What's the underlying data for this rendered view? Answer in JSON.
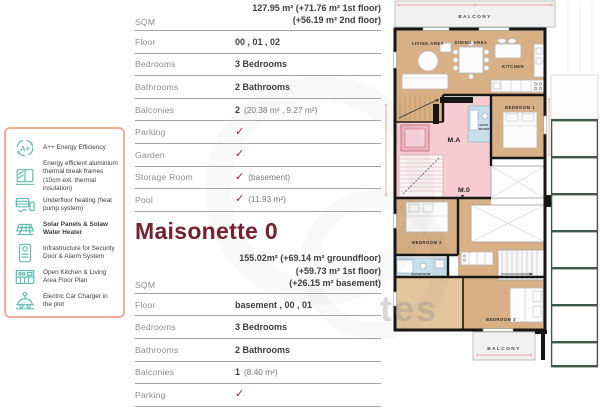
{
  "features": {
    "items": [
      {
        "icon": "energy-rating-icon",
        "label": "A++ Energy Efficiency"
      },
      {
        "icon": "window-frame-icon",
        "label": "Energy efficient aluminium thermal break frames (10cm ext. thermal insulation)"
      },
      {
        "icon": "underfloor-heating-icon",
        "label": "Underfloor heating (heat pump system)"
      },
      {
        "icon": "solar-panel-icon",
        "label": "Solar Panels & Solaw Water Heater"
      },
      {
        "icon": "security-icon",
        "label": "Infrastructure for Security Door & Alarm System"
      },
      {
        "icon": "kitchen-icon",
        "label": "Open Kitchen & Living Area Floor Plan"
      },
      {
        "icon": "car-charger-icon",
        "label": "Electric Car Charger in the plot"
      }
    ]
  },
  "unit_top": {
    "sqm_label": "SQM",
    "sqm_lines": [
      "127.95 m² (+71.76 m² 1st floor)",
      "(+56.19 m² 2nd floor)"
    ],
    "rows": [
      {
        "label": "Floor",
        "value": "00 , 01 , 02"
      },
      {
        "label": "Bedrooms",
        "value": "3 Bedrooms"
      },
      {
        "label": "Bathrooms",
        "value": "2 Bathrooms"
      },
      {
        "label": "Balconies",
        "value": "2",
        "muted": "(20.38 m² , 9.27 m²)"
      },
      {
        "label": "Parking",
        "check": "✓"
      },
      {
        "label": "Garden",
        "check": "✓"
      },
      {
        "label": "Storage Room",
        "check": "✓",
        "muted": "(basement)"
      },
      {
        "label": "Pool",
        "check": "✓",
        "muted": "(11.93 m²)"
      }
    ]
  },
  "maisonette": {
    "title": "Maisonette 0",
    "sqm_label": "SQM",
    "sqm_lines": [
      "155.02m²  (+69.14 m² groundfloor)",
      "(+59.73 m² 1st floor)",
      "(+26.15 m² basement)"
    ],
    "rows": [
      {
        "label": "Floor",
        "value": "basement , 00 , 01"
      },
      {
        "label": "Bedrooms",
        "value": "3 Bedrooms"
      },
      {
        "label": "Bathrooms",
        "value": "2 Bathrooms"
      },
      {
        "label": "Balconies",
        "value": "1",
        "muted": "(8.40 m²)"
      },
      {
        "label": "Parking",
        "check": "✓"
      }
    ]
  },
  "floorplan": {
    "balcony_top": "BALCONY",
    "living_area": "LIVING AREA",
    "dining_area": "DINING AREA",
    "kitchen": "KITCHEN",
    "bedroom_1": "BEDROOM 1",
    "bath_line1": "BATH",
    "bath_line2": "ROOM",
    "unit_a": "M.A",
    "unit_0": "M.0",
    "bedroom_2": "BEDROOM 2",
    "bathroom": "BATHROOM",
    "bedroom_3": "BEDROOM 3",
    "balcony_bottom": "BALCONY"
  },
  "watermark": "tes",
  "colors": {
    "maroon": "#74222F",
    "check": "#8E2438",
    "teal": "#5FBDB2",
    "panel-border": "#F5AC9E",
    "wood": "#D9B086",
    "pink": "#F6CBD1",
    "blue": "#C8E0EC",
    "wall": "#161616",
    "balc": "#F1F1F1",
    "pergola": "#3E5947",
    "dim": "#E0604F"
  }
}
